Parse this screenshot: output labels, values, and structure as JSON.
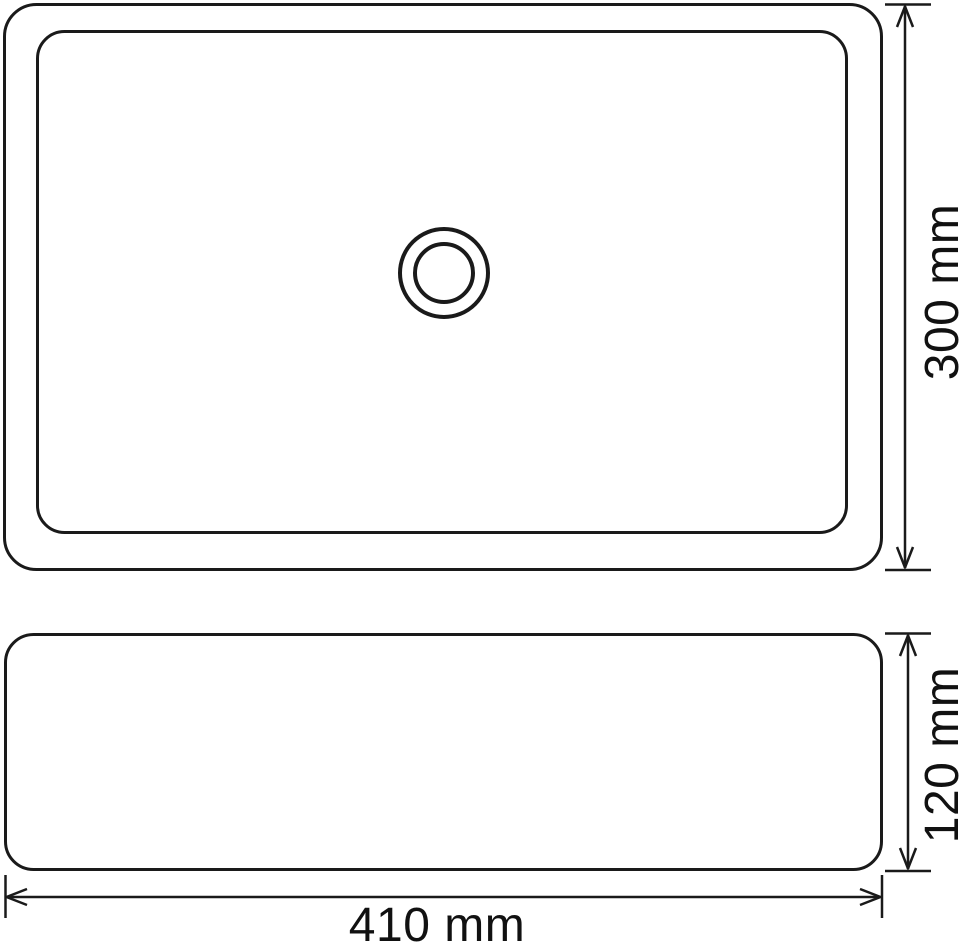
{
  "colors": {
    "background": "#ffffff",
    "line": "#1a1a1a",
    "text": "#111111"
  },
  "dimensions": {
    "basin_depth": {
      "label": "300 mm"
    },
    "basin_height": {
      "label": "120 mm"
    },
    "basin_width": {
      "label": "410 mm"
    }
  }
}
